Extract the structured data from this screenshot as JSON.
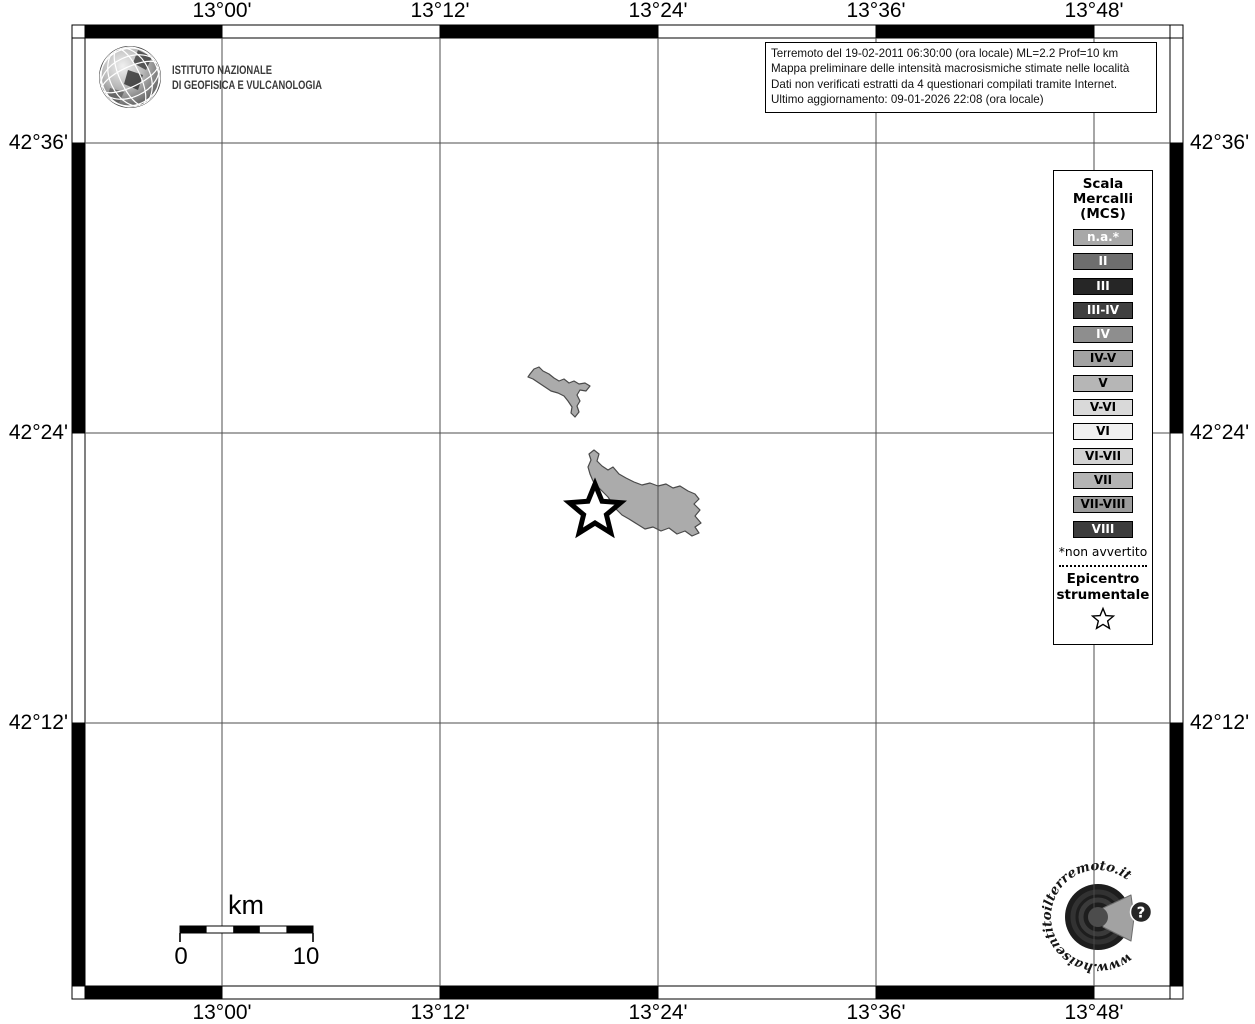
{
  "axis": {
    "lon_labels": [
      "13°00'",
      "13°12'",
      "13°24'",
      "13°36'",
      "13°48'"
    ],
    "lat_labels": [
      "42°36'",
      "42°24'",
      "42°12'"
    ]
  },
  "ingv": {
    "line1": "ISTITUTO NAZIONALE",
    "line2": "DI GEOFISICA E VULCANOLOGIA"
  },
  "info_box": {
    "line1": "Terremoto del 19-02-2011 06:30:00 (ora locale) ML=2.2 Prof=10 km",
    "line2": "Mappa preliminare delle intensità macrosismiche stimate nelle località",
    "line3": "Dati non verificati estratti da 4 questionari compilati tramite Internet.",
    "line4": "Ultimo aggiornamento: 09-01-2026 22:08 (ora locale)"
  },
  "legend": {
    "title": "Scala\nMercalli\n(MCS)",
    "items": [
      {
        "label": "n.a.*",
        "bg": "#a8a8a8",
        "fg": "#ffffff"
      },
      {
        "label": "II",
        "bg": "#6e6e6e",
        "fg": "#ffffff"
      },
      {
        "label": "III",
        "bg": "#262626",
        "fg": "#ffffff"
      },
      {
        "label": "III-IV",
        "bg": "#404040",
        "fg": "#ffffff"
      },
      {
        "label": "IV",
        "bg": "#8e8e8e",
        "fg": "#ffffff"
      },
      {
        "label": "IV-V",
        "bg": "#a2a2a2",
        "fg": "#000000"
      },
      {
        "label": "V",
        "bg": "#b6b6b6",
        "fg": "#000000"
      },
      {
        "label": "V-VI",
        "bg": "#d9d9d9",
        "fg": "#000000"
      },
      {
        "label": "VI",
        "bg": "#f0f0f0",
        "fg": "#000000"
      },
      {
        "label": "VI-VII",
        "bg": "#d2d2d2",
        "fg": "#000000"
      },
      {
        "label": "VII",
        "bg": "#b4b4b4",
        "fg": "#000000"
      },
      {
        "label": "VII-VIII",
        "bg": "#9c9c9c",
        "fg": "#000000"
      },
      {
        "label": "VIII",
        "bg": "#3c3c3c",
        "fg": "#ffffff"
      }
    ],
    "footnote": "*non avvertito",
    "epicenter_label": "Epicentro\nstrumentale",
    "epicenter_symbol": "star-outline-icon"
  },
  "scale_bar": {
    "unit": "km",
    "start": "0",
    "end": "10"
  },
  "map": {
    "region_fill": "#ababab",
    "region_stroke": "#4a4a4a",
    "grid_color": "#4d4d4d",
    "epicenter_marker": "star"
  },
  "watermark": {
    "url_text": "www.haisentitoilterremoto.it",
    "question_mark": "?"
  }
}
